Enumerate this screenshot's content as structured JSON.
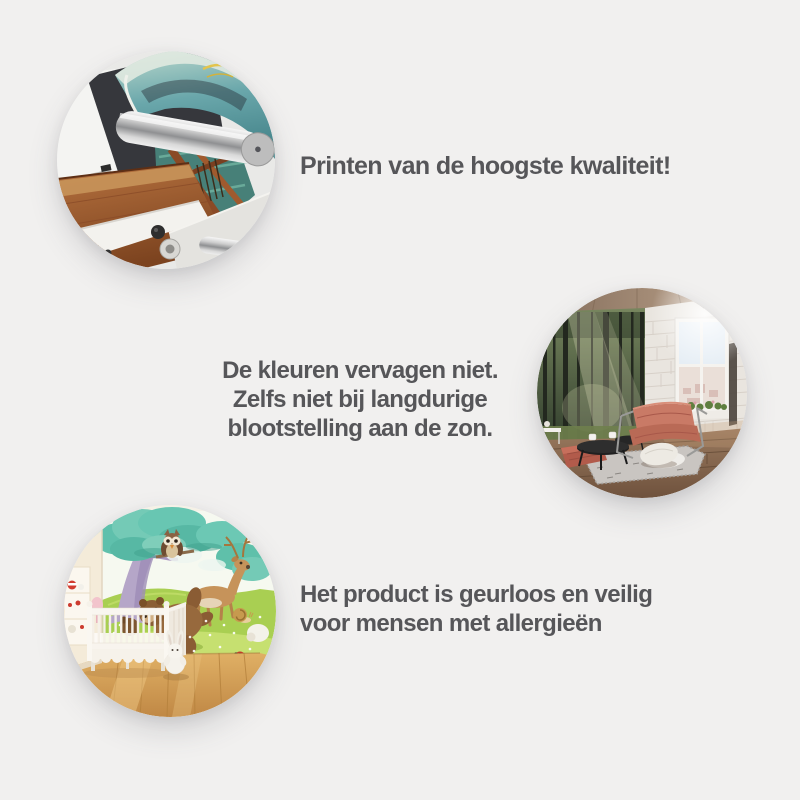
{
  "page": {
    "type": "product-feature-infographic",
    "language": "nl",
    "background_color": "#f1f0ef",
    "text_color": "#565659"
  },
  "features": [
    {
      "id": "print-quality",
      "image_alt": "Close-up of a large-format printer with silver roller printing a colorful canvas",
      "lines": [
        "Printen van de hoogste kwaliteit!"
      ]
    },
    {
      "id": "fade-resistant",
      "image_alt": "Sunlit loft living room with forest photo wall mural, leather chair and white brick wall",
      "lines": [
        "De kleuren vervagen niet.",
        "Zelfs niet bij langdurige",
        "blootstelling aan de zon."
      ]
    },
    {
      "id": "odorless-allergy-safe",
      "image_alt": "Nursery with cartoon forest-animals wall mural, white crib and plush bunny",
      "lines": [
        "Het product is geurloos en veilig",
        "voor mensen met allergieën"
      ]
    }
  ]
}
